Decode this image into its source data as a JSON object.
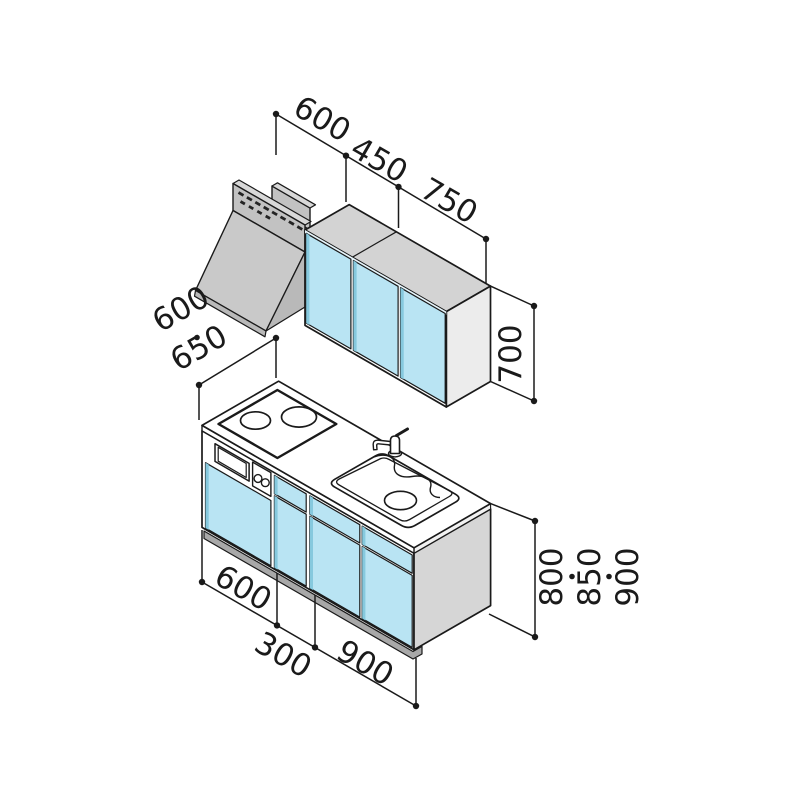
{
  "palette": {
    "line": "#1a1a1a",
    "door_blue": "#b9e4f3",
    "door_blue_edge": "#86c9de",
    "door_top_sliver": "#e8f6fc",
    "cabinet_gray_top": "#d3d3d3",
    "cabinet_gray_side": "#ececec",
    "base_side_gray": "#d6d6d6",
    "hood_gray": "#c2c2c2",
    "hood_gray_light": "#d8d8d8",
    "hood_gray_dark": "#b9b9b9",
    "toe_kick_gray": "#a8a8a8",
    "background": "#ffffff"
  },
  "dims": {
    "top": [
      "600",
      "450",
      "750"
    ],
    "depth": [
      "600",
      "650"
    ],
    "depth_display": "600・650",
    "upper_height": "700",
    "bottom": [
      "600",
      "300",
      "900"
    ],
    "heights": [
      "800",
      "850",
      "900"
    ],
    "heights_display": "800・850・900"
  }
}
